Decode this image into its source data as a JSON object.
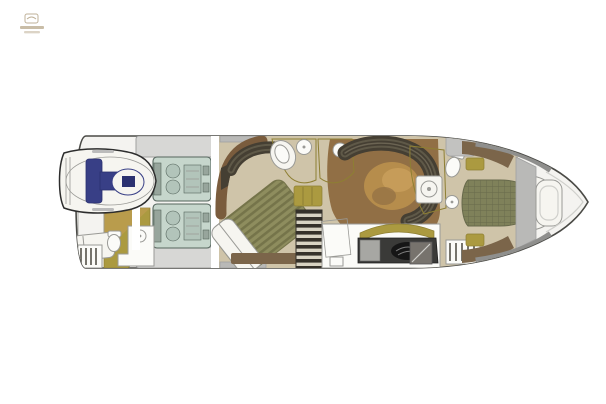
{
  "figure": {
    "type": "deck-plan",
    "subject": "motor-yacht-lower-deck-floor-plan"
  },
  "watermark": {
    "glyph": "builder-logo-emblem",
    "legible": false
  },
  "colors": {
    "bg": "#ffffff",
    "hull_fill": "#f4f3f0",
    "hull_stroke": "#4a4a46",
    "floor_tan": "#cfc4a9",
    "floor_brown": "#916f45",
    "wall_brown": "#7a5c3d",
    "cabinet_brown": "#7b654a",
    "olive": "#ab9a40",
    "olive_line": "#8e7f33",
    "sofa_dark": "#453f33",
    "sofa_mid": "#5f5948",
    "sofa_line": "#6b6453",
    "duvet_a": "#8e8d5e",
    "duvet_b": "#75744a",
    "bed_check_base": "#7f815a",
    "bed_check_line": "#67694b",
    "engine_fill": "#c6d6cc",
    "engine_sub": "#b2c4ba",
    "engine_stroke": "#55655d",
    "engine_detail": "#97a59c",
    "tender_stroke": "#2d2d2d",
    "tender_blue": "#383f86",
    "tender_blue_dark": "#2b3170",
    "hatch_fill": "#d7d7d5",
    "hatch_stroke": "#a0a0a0",
    "deck_gray": "#8f8f8d",
    "bulkhead_gray": "#b9b9b7",
    "window_gray": "#c2c2c0",
    "stairs_dark": "#35312a",
    "stairs_light": "#d8d3c3",
    "white_fix": "#fbfbf8",
    "fix_stroke": "#9a9a96",
    "berth_white": "#f6f5f0",
    "teak_a": "#a3916d",
    "teak_b": "#6d5f45",
    "counter_dark": "#3a3a38",
    "cooktop": "#161616",
    "appliance": "#a7a7a3",
    "table_tan": "#b68d4c",
    "table_light": "#caa05c",
    "dot_tan": "#c4b27a",
    "hanger": "#55524a",
    "watermark": "#bfb198",
    "outline_soft": "#cfcfcb",
    "white": "#ffffff"
  }
}
